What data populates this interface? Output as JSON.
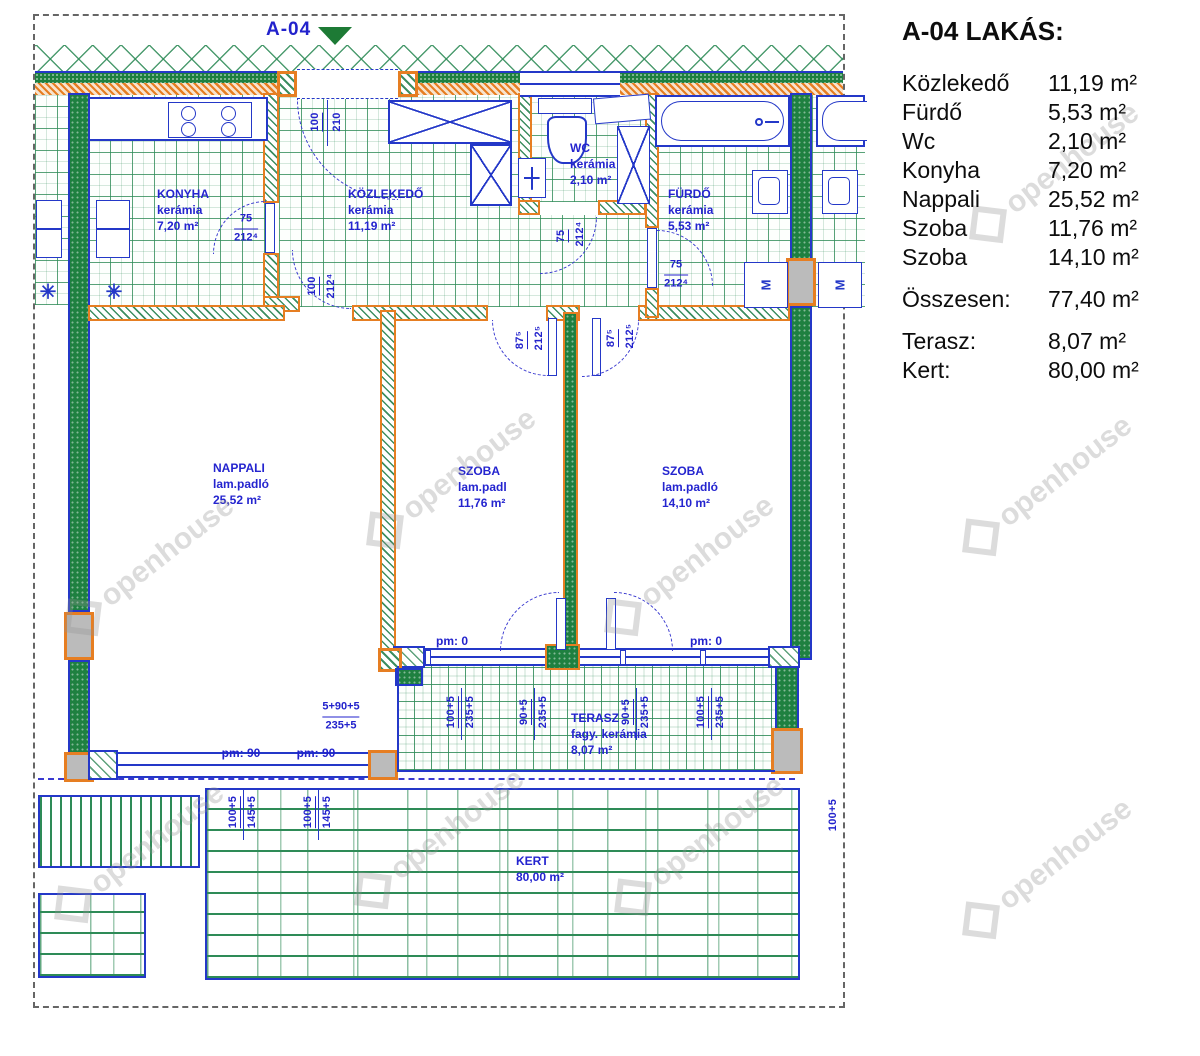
{
  "marker": {
    "label": "A-04"
  },
  "watermark": {
    "text": "openhouse"
  },
  "symbols": {
    "star": "✳"
  },
  "labels": {
    "m": "M"
  },
  "colors": {
    "blue": "#2438c8",
    "green": "#2e8b57",
    "dark_green": "#1e8040",
    "orange": "#e67e22",
    "gray_column": "#bbbbbb",
    "label_blue": "#2424cf"
  },
  "legend": {
    "title": "A-04 LAKÁS:",
    "rows": [
      {
        "label": "Közlekedő",
        "value": "11,19 m²"
      },
      {
        "label": "Fürdő",
        "value": "5,53 m²"
      },
      {
        "label": "Wc",
        "value": "2,10 m²"
      },
      {
        "label": "Konyha",
        "value": "7,20 m²"
      },
      {
        "label": "Nappali",
        "value": "25,52 m²"
      },
      {
        "label": "Szoba",
        "value": "11,76 m²"
      },
      {
        "label": "Szoba",
        "value": "14,10 m²"
      }
    ],
    "total": {
      "label": "Összesen:",
      "value": "77,40 m²"
    },
    "extras": [
      {
        "label": "Terasz:",
        "value": "8,07 m²"
      },
      {
        "label": "Kert:",
        "value": "80,00 m²"
      }
    ]
  },
  "rooms": {
    "konyha": {
      "name": "KONYHA",
      "material": "kerámia",
      "area": "7,20 m²"
    },
    "kozlekedo": {
      "name": "KÖZLEKEDŐ",
      "material": "kerámia",
      "area": "11,19 m²"
    },
    "wc": {
      "name": "WC",
      "material": "kerámia",
      "area": "2,10 m²"
    },
    "furdo": {
      "name": "FÜRDŐ",
      "material": "kerámia",
      "area": "5,53 m²"
    },
    "nappali": {
      "name": "NAPPALI",
      "material": "lam.padló",
      "area": "25,52 m²"
    },
    "szoba1": {
      "name": "SZOBA",
      "material": "lam.padl",
      "area": "11,76 m²"
    },
    "szoba2": {
      "name": "SZOBA",
      "material": "lam.padló",
      "area": "14,10 m²"
    },
    "terasz": {
      "name": "TERASZ",
      "material": "fagy. kerámia",
      "area": "8,07 m²"
    },
    "kert": {
      "name": "KERT",
      "area": "80,00 m²"
    }
  },
  "dims": {
    "konyha_door": {
      "w": "75",
      "h": "212⁴"
    },
    "entry": {
      "w": "100",
      "h": "210"
    },
    "hall_pass": {
      "w": "100",
      "h": "212⁴"
    },
    "wc_door": {
      "w": "75",
      "h": "212⁴"
    },
    "furdo_door": {
      "w": "75",
      "h": "212⁴"
    },
    "szoba1_door": {
      "w": "87⁵",
      "h": "212⁵"
    },
    "szoba2_door": {
      "w": "87⁵",
      "h": "212⁵"
    },
    "pm_zero": "pm: 0",
    "pm_ninety": "pm: 90",
    "terasz_1": {
      "a": "100+5",
      "b": "235+5"
    },
    "terasz_2": {
      "a": "90+5",
      "b": "235+5"
    },
    "terasz_3": {
      "a": "90+5",
      "b": "235+5"
    },
    "terasz_4": {
      "a": "100+5",
      "b": "235+5"
    },
    "nappali_window": {
      "a": "5+90+5",
      "b": "235+5"
    },
    "left_1": {
      "a": "100+5",
      "b": "145+5"
    },
    "left_2": {
      "a": "100+5",
      "b": "145+5"
    },
    "garden_right": "100+5"
  }
}
